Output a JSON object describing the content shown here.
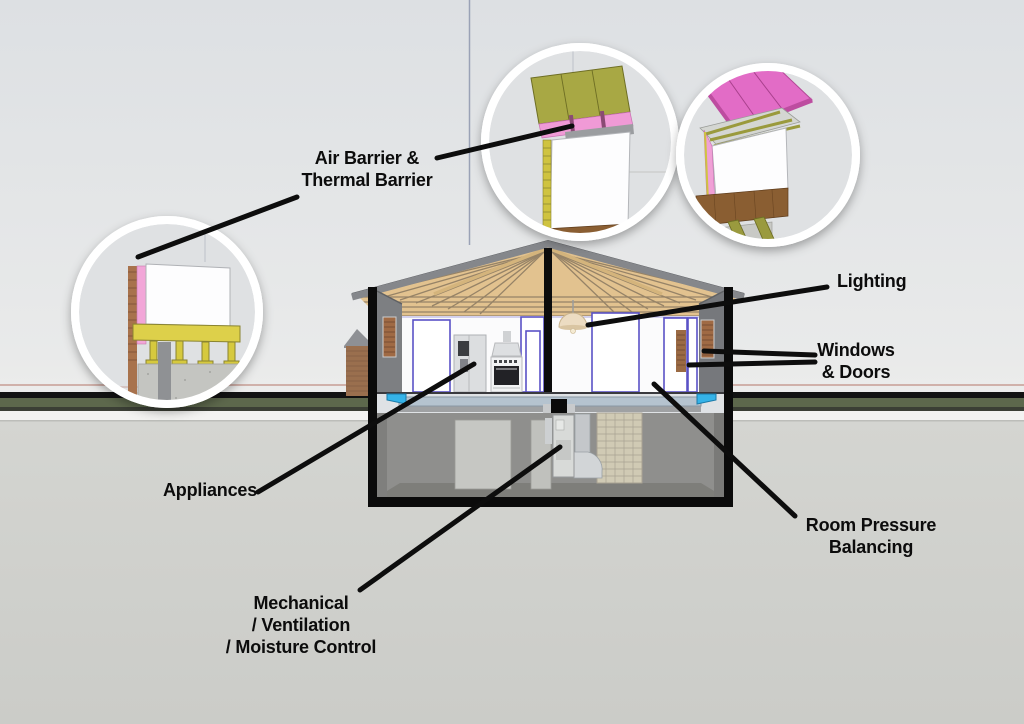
{
  "callouts": {
    "air_barrier": {
      "line1": "Air Barrier &",
      "line2": "Thermal Barrier"
    },
    "lighting": {
      "label": "Lighting"
    },
    "windows_doors": {
      "line1": "Windows",
      "line2": "& Doors"
    },
    "appliances": {
      "label": "Appliances"
    },
    "room_pressure": {
      "line1": "Room Pressure",
      "line2": "Balancing"
    },
    "mechanical": {
      "line1": "Mechanical",
      "line2": "/ Ventilation",
      "line3": "/ Moisture Control"
    }
  },
  "colors": {
    "label_text": "#0c0c0c",
    "leader_line": "#0d0d0d",
    "sky": "#dfe1e4",
    "ground": "#d0d1cd",
    "grass_strip": "#5d684c",
    "curb_black": "#121212",
    "house_outline": "#0b0b0b",
    "roof_wood_tan": "#e2c28f",
    "gable_wall_gray": "#7d7f82",
    "insulation_pink": "#ee82cc",
    "sheathing_olive": "#a8a844",
    "door_trim_blue": "#5a52c6",
    "basement_gray": "#8f8f8d",
    "beam_cyan": "#35b3e8",
    "brick": "#9a6f4e"
  }
}
